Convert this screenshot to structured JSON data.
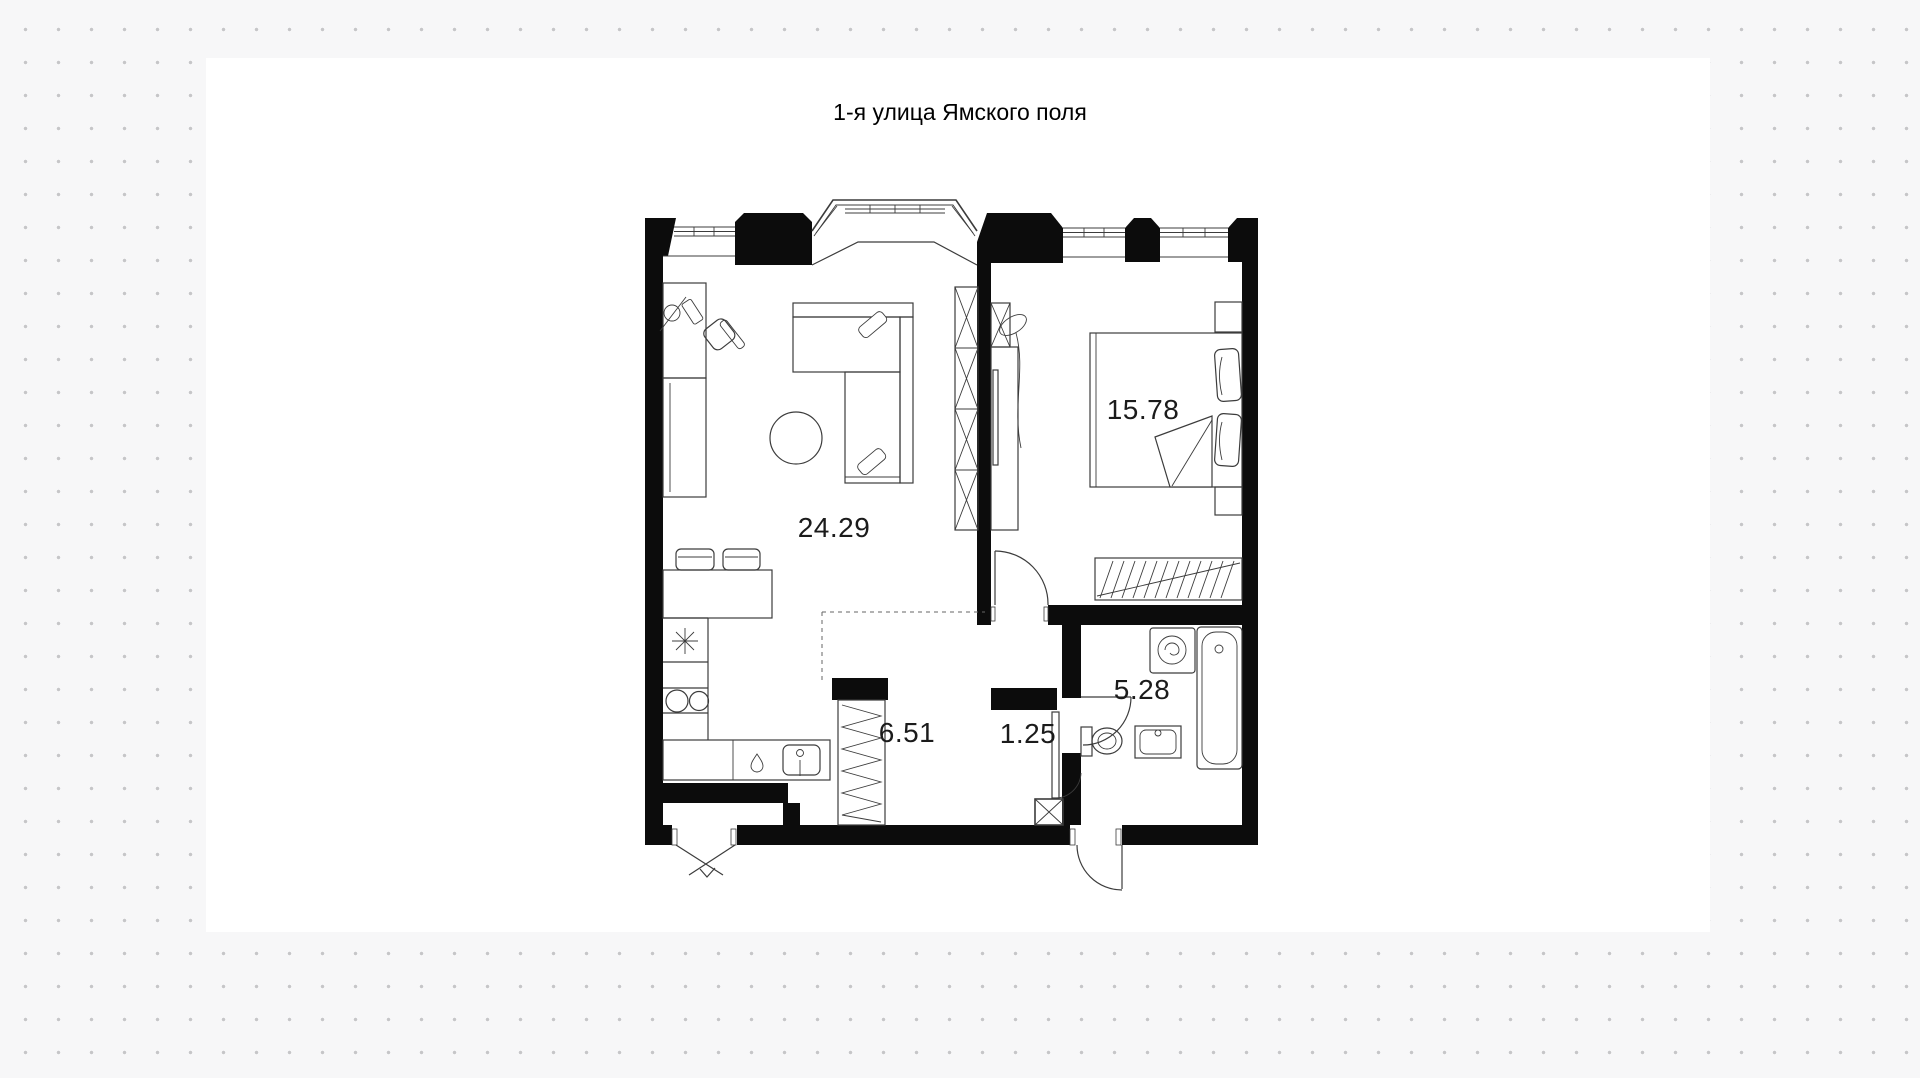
{
  "title": "1-я улица Ямского поля",
  "rooms": {
    "living_kitchen": {
      "area": "24.29"
    },
    "bedroom": {
      "area": "15.78"
    },
    "bathroom": {
      "area": "5.28"
    },
    "hallway": {
      "area": "6.51"
    },
    "closet": {
      "area": "1.25"
    }
  },
  "colors": {
    "background": "#f7f7f8",
    "dots": "#c6c6c8",
    "plan_background": "#ffffff",
    "walls": "#0c0c0c",
    "furniture_lines": "#3c3c3c",
    "labels": "#1b1b1b"
  }
}
